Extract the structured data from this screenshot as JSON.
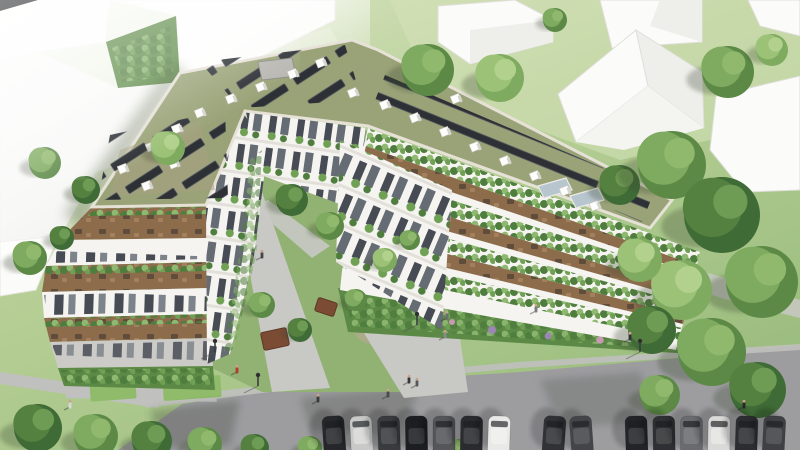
{
  "scene": {
    "title": "Aerial 3D architectural rendering of a V-shaped residential complex with green roofs, photovoltaic panels, planted terraces, inner courtyard garden and street parking",
    "labels": {
      "complex": "v-shaped-apartment-building",
      "left_wing": "west wing with stepped street-facing terraces",
      "right_wing": "east wing with stepped garden terraces",
      "roof": "extensive green roof with photovoltaic arrays, vents and skylights",
      "courtyard": "landscaped inner courtyard with walkways and pergolas",
      "street": "asphalt street with a row of angle-parked cars",
      "context": "white untextured massing buildings on lawns"
    },
    "palette": {
      "grassLight": "#d6e2ba",
      "grassMid": "#aac687",
      "grassDark": "#88ab68",
      "treeDark": "#3f6b36",
      "treeMid": "#5c8a46",
      "treeLight": "#7fab60",
      "treeLite2": "#9cc277",
      "roofGreen": "#9aa378",
      "roofEdge": "#e9e4da",
      "solar": "#2d3136",
      "facade": "#f5f4f1",
      "facadeShade": "#dcdbd7",
      "window": "#474c54",
      "windowLight": "#7d838a",
      "deck": "#8d6c4c",
      "deckDark": "#5f4c3a",
      "deckLight": "#a3815f",
      "plant1": "#4f7d3e",
      "plant2": "#6fa054",
      "plant3": "#8fb971",
      "massing": "#fbfbf9",
      "massingSide": "#eeeeea",
      "massingEdge": "#d9d8d3",
      "street": "#9d9da0",
      "streetShade": "#85868a",
      "sidewalk": "#c0c0be",
      "path": "#c8c8c4",
      "courtyard": "#92b274",
      "soil": "#b4a98e",
      "pergola": "#7c4b33",
      "blackRoof": "#17181a",
      "skylight": "#b7c5cf",
      "flower": "#9b86b4",
      "lawnPad": "#8fbb6a"
    },
    "roof_features": {
      "skylight_count": 2,
      "shed_count": 1,
      "vents": [
        [
          122,
          168
        ],
        [
          150,
          146
        ],
        [
          176,
          128
        ],
        [
          146,
          185
        ],
        [
          173,
          163
        ],
        [
          199,
          112
        ],
        [
          230,
          98
        ],
        [
          260,
          86
        ],
        [
          292,
          73
        ],
        [
          320,
          62
        ],
        [
          352,
          92
        ],
        [
          384,
          104
        ],
        [
          414,
          117
        ],
        [
          444,
          131
        ],
        [
          474,
          146
        ],
        [
          504,
          160
        ],
        [
          534,
          175
        ],
        [
          564,
          190
        ],
        [
          594,
          205
        ],
        [
          420,
          86
        ],
        [
          455,
          98
        ]
      ]
    },
    "street_row": {
      "car_count": 15,
      "car_colors": [
        "#26272b",
        "#c9cac8",
        "#3a3b3f",
        "#1d1e21",
        "#55565a",
        "#2a2b2f",
        "#e9e9e7",
        null,
        "#303236",
        "#434549",
        null,
        "#232428",
        "#2e3033",
        "#6a6b6f",
        "#dadad8",
        "#2c2d31",
        "#3e4044"
      ],
      "lamps": [
        [
          258,
          386
        ],
        [
          417,
          325
        ],
        [
          640,
          352
        ],
        [
          215,
          352
        ]
      ]
    },
    "people": [
      [
        237,
        367,
        "#b03a2e"
      ],
      [
        318,
        396,
        "#3a3a3e"
      ],
      [
        388,
        391,
        "#4a4a4e"
      ],
      [
        409,
        377,
        "#35353a"
      ],
      [
        417,
        380,
        "#57575c"
      ],
      [
        447,
        313,
        "#6b6b70"
      ],
      [
        445,
        332,
        "#8a8a90"
      ],
      [
        630,
        334,
        "#323236"
      ],
      [
        744,
        402,
        "#27272b"
      ],
      [
        536,
        306,
        "#7a7a80"
      ],
      [
        262,
        252,
        "#45454a"
      ],
      [
        70,
        402,
        "#d8d8d6"
      ]
    ],
    "trees": [
      [
        45,
        163,
        16,
        1
      ],
      [
        86,
        190,
        14,
        0
      ],
      [
        168,
        148,
        17,
        2
      ],
      [
        30,
        258,
        17,
        1
      ],
      [
        62,
        238,
        12,
        0
      ],
      [
        292,
        200,
        16,
        0
      ],
      [
        330,
        226,
        14,
        1
      ],
      [
        262,
        305,
        13,
        1
      ],
      [
        300,
        330,
        12,
        0
      ],
      [
        356,
        300,
        11,
        1
      ],
      [
        385,
        260,
        12,
        2
      ],
      [
        410,
        240,
        10,
        1
      ],
      [
        428,
        70,
        26,
        1
      ],
      [
        500,
        78,
        24,
        2
      ],
      [
        555,
        20,
        12,
        1
      ],
      [
        728,
        72,
        26,
        1
      ],
      [
        772,
        50,
        16,
        2
      ],
      [
        620,
        185,
        20,
        0
      ],
      [
        672,
        165,
        34,
        1
      ],
      [
        722,
        215,
        38,
        0
      ],
      [
        762,
        282,
        36,
        1
      ],
      [
        682,
        290,
        30,
        2
      ],
      [
        640,
        260,
        22,
        2
      ],
      [
        652,
        330,
        24,
        0
      ],
      [
        712,
        352,
        34,
        1
      ],
      [
        758,
        390,
        28,
        0
      ],
      [
        660,
        395,
        20,
        1
      ],
      [
        38,
        428,
        24,
        0
      ],
      [
        96,
        436,
        22,
        1
      ],
      [
        152,
        441,
        20,
        0
      ],
      [
        205,
        444,
        17,
        1
      ],
      [
        255,
        448,
        14,
        0
      ],
      [
        310,
        448,
        12,
        1
      ],
      [
        458,
        449,
        10,
        1
      ]
    ]
  }
}
